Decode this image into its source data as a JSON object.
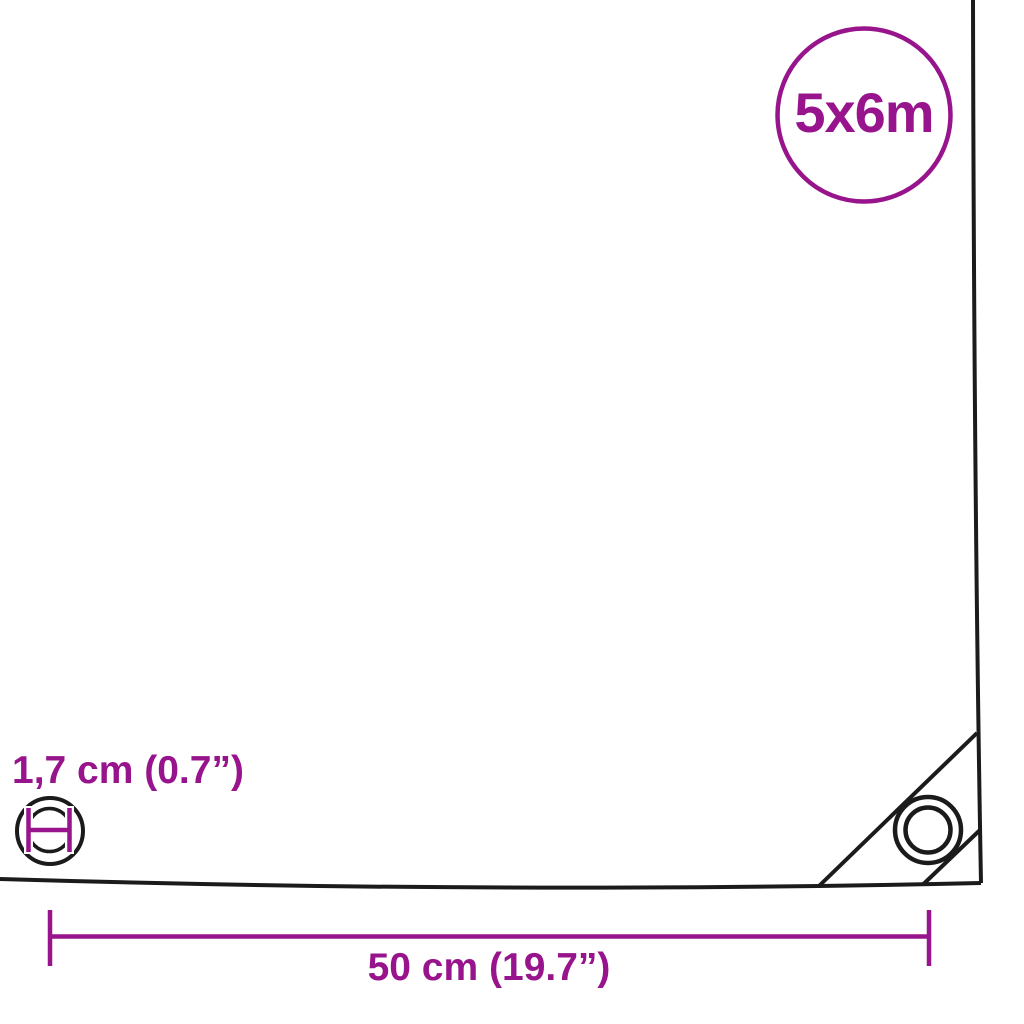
{
  "colors": {
    "accent_purple": "#98148c",
    "line_black": "#1b1b1b",
    "background": "#ffffff"
  },
  "diagram": {
    "size_badge": {
      "label": "5x6m"
    },
    "eyelet_measurement": {
      "label": "1,7 cm (0.7”)",
      "value_cm": "1,7",
      "value_inch": "0.7"
    },
    "width_measurement": {
      "label": "50 cm (19.7”)",
      "value_cm": "50",
      "value_inch": "19.7"
    }
  }
}
